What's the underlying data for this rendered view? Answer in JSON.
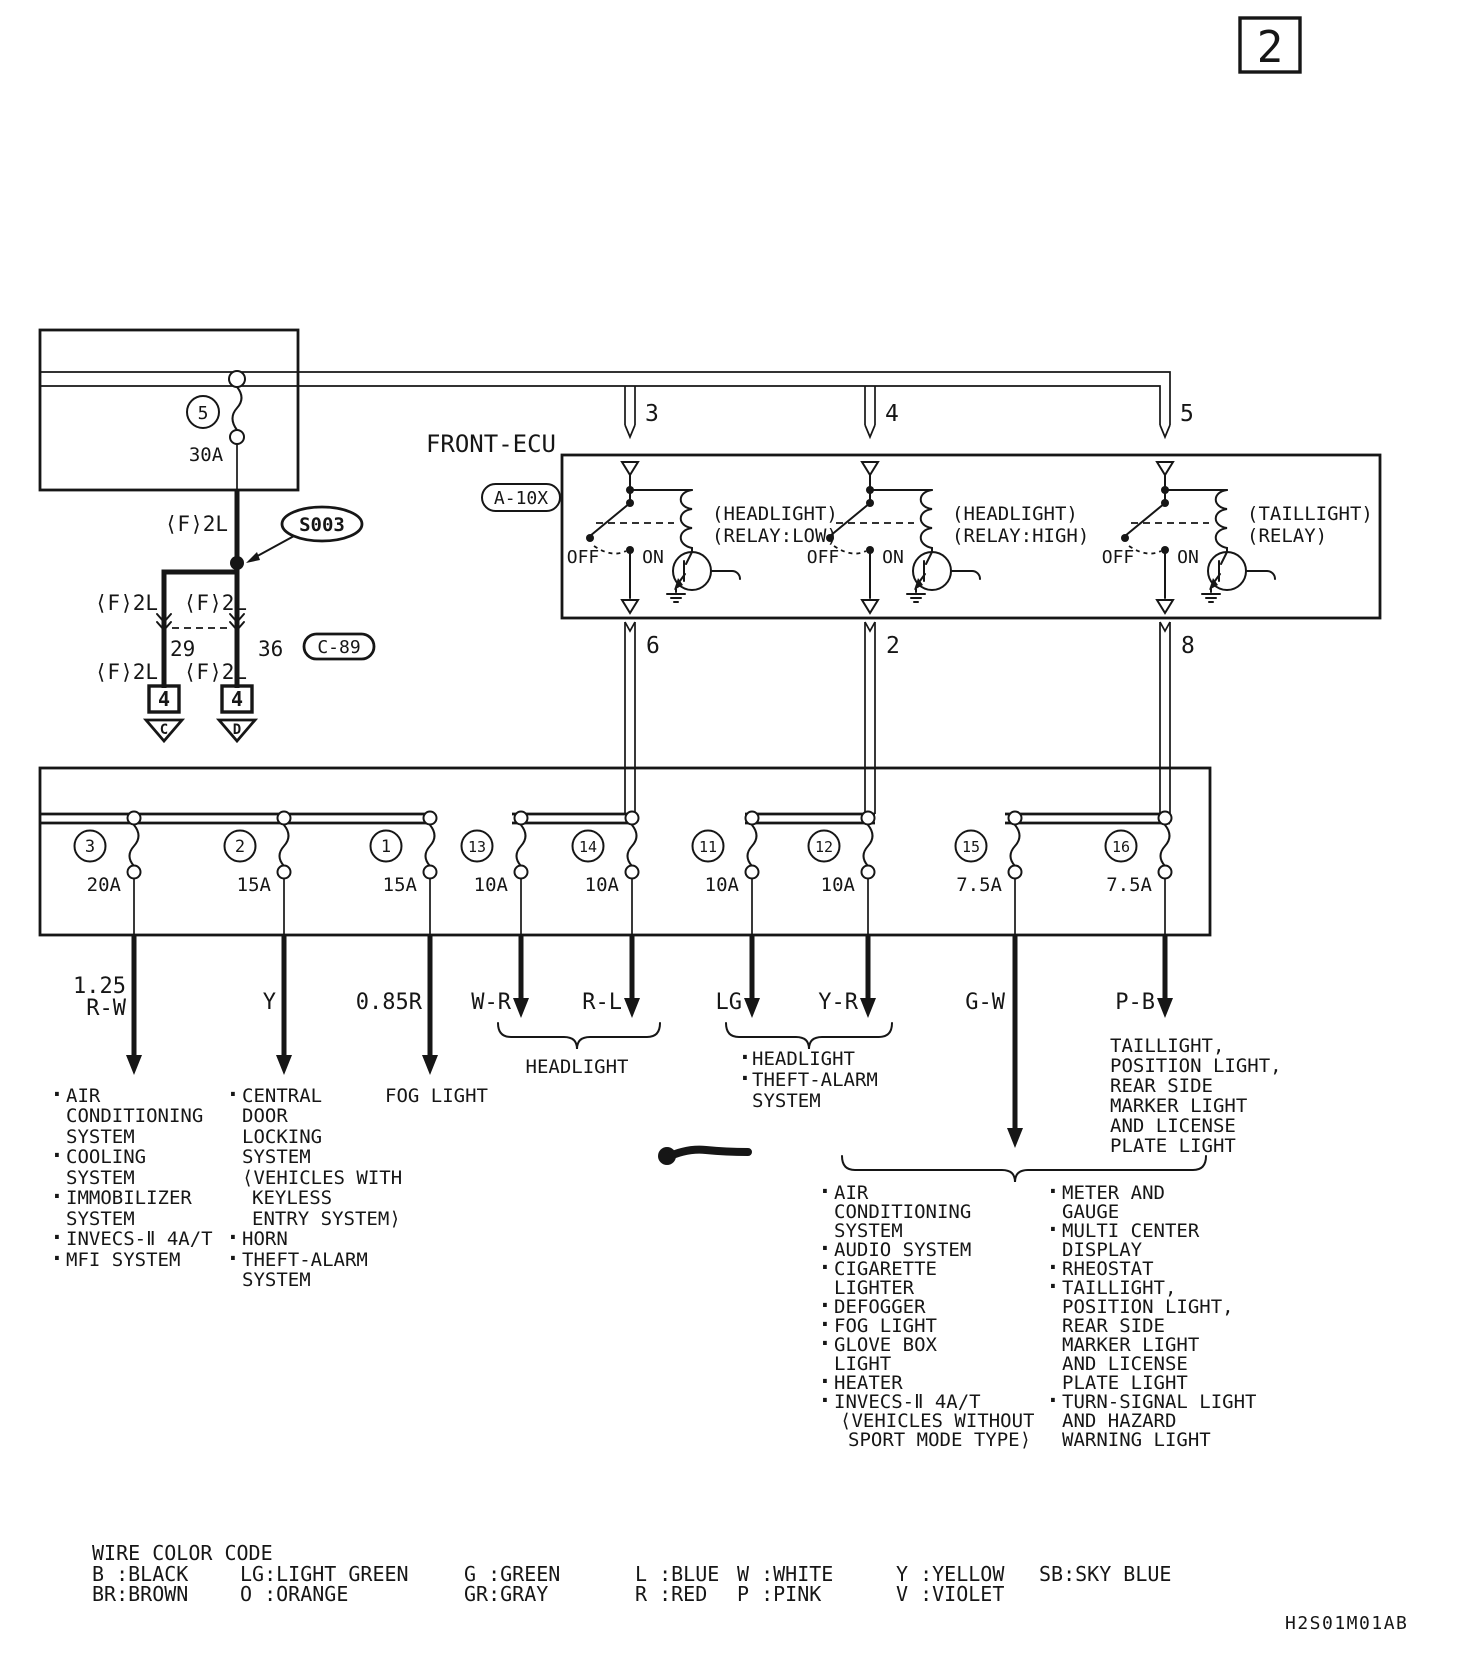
{
  "page": {
    "number": "2",
    "doc_code": "H2S01M01AB"
  },
  "glyphs": {
    "bullet": "·"
  },
  "feed_circuit": {
    "fuse_id": "5",
    "fuse_amp": "30A",
    "gauge": "⟨F⟩2L",
    "splice": "S003",
    "pin_left": "29",
    "pin_right": "36",
    "connector": "C-89",
    "terminal": "4",
    "dest_left": "C",
    "dest_right": "D"
  },
  "ecu": {
    "title": "FRONT-ECU",
    "connector": "A-10X",
    "pins_top": [
      "3",
      "4",
      "5"
    ],
    "pins_bottom": [
      "6",
      "2",
      "8"
    ],
    "off": "OFF",
    "on": "ON",
    "relays": [
      {
        "line1": "(HEADLIGHT)",
        "line2": "(RELAY:LOW)"
      },
      {
        "line1": "(HEADLIGHT)",
        "line2": "(RELAY:HIGH)"
      },
      {
        "line1": "(TAILLIGHT)",
        "line2": "(RELAY)"
      }
    ]
  },
  "fuses": [
    {
      "id": "3",
      "amp": "20A"
    },
    {
      "id": "2",
      "amp": "15A"
    },
    {
      "id": "1",
      "amp": "15A"
    },
    {
      "id": "13",
      "amp": "10A"
    },
    {
      "id": "14",
      "amp": "10A"
    },
    {
      "id": "11",
      "amp": "10A"
    },
    {
      "id": "12",
      "amp": "10A"
    },
    {
      "id": "15",
      "amp": "7.5A"
    },
    {
      "id": "16",
      "amp": "7.5A"
    }
  ],
  "wires": {
    "size0": "1.25",
    "codes": [
      "R-W",
      "Y",
      "0.85R",
      "W-R",
      "R-L",
      "LG",
      "Y-R",
      "G-W",
      "P-B"
    ]
  },
  "dest": {
    "rw": [
      "AIR",
      "CONDITIONING",
      "SYSTEM",
      "COOLING",
      "SYSTEM",
      "IMMOBILIZER",
      "SYSTEM",
      "INVECS-Ⅱ 4A/T",
      "MFI SYSTEM"
    ],
    "y": [
      "CENTRAL",
      "DOOR",
      "LOCKING",
      "SYSTEM",
      "⟨VEHICLES WITH",
      "KEYLESS",
      "ENTRY SYSTEM⟩",
      "HORN",
      "THEFT-ALARM",
      "SYSTEM"
    ],
    "r": "FOG LIGHT",
    "wr_rl": "HEADLIGHT",
    "lg_yr": [
      "HEADLIGHT",
      "THEFT-ALARM",
      "SYSTEM"
    ],
    "pb": [
      "TAILLIGHT,",
      "POSITION LIGHT,",
      "REAR SIDE",
      "MARKER LIGHT",
      "AND LICENSE",
      "PLATE LIGHT"
    ],
    "gw_left": [
      "AIR",
      "CONDITIONING",
      "SYSTEM",
      "AUDIO SYSTEM",
      "CIGARETTE",
      "LIGHTER",
      "DEFOGGER",
      "FOG LIGHT",
      "GLOVE BOX",
      "LIGHT",
      "HEATER",
      "INVECS-Ⅱ 4A/T",
      "⟨VEHICLES WITHOUT",
      "SPORT MODE TYPE⟩"
    ],
    "gw_right": [
      "METER AND",
      "GAUGE",
      "MULTI CENTER",
      "DISPLAY",
      "RHEOSTAT",
      "TAILLIGHT,",
      "POSITION LIGHT,",
      "REAR SIDE",
      "MARKER LIGHT",
      "AND LICENSE",
      "PLATE LIGHT",
      "TURN-SIGNAL LIGHT",
      "AND HAZARD",
      "WARNING LIGHT"
    ]
  },
  "legend": {
    "title": "WIRE COLOR CODE",
    "row1": [
      "B :BLACK",
      "LG:LIGHT GREEN",
      "G :GREEN",
      "L :BLUE",
      "W :WHITE",
      "Y :YELLOW",
      "SB:SKY BLUE"
    ],
    "row2": [
      "BR:BROWN",
      "O :ORANGE",
      "GR:GRAY",
      "R :RED",
      "P :PINK",
      "V :VIOLET"
    ]
  }
}
